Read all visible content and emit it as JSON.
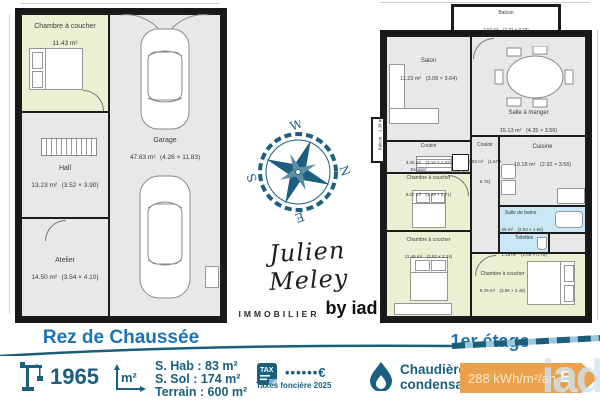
{
  "colors": {
    "teal": "#1A5F7D",
    "title_blue": "#1B74B5",
    "wall": "#181818",
    "room_gray": "#E8E8E8",
    "room_yellow": "#EDEFD2",
    "room_blue": "#C9E7F5",
    "energy_orange": "#EBA14C"
  },
  "ground_floor": {
    "title": "Rez de Chaussée",
    "rooms": [
      {
        "name": "Chambre à coucher",
        "area": "11.43 m²",
        "dims": ""
      },
      {
        "name": "Hall",
        "area": "13.23 m²",
        "dims": "(3.52 × 3.90)"
      },
      {
        "name": "Garage",
        "area": "47.63 m²",
        "dims": "(4.26 × 11.83)"
      },
      {
        "name": "Atelier",
        "area": "14.50 m²",
        "dims": "(3.54 × 4.10)"
      }
    ]
  },
  "first_floor": {
    "title": "1er étage",
    "rooms": [
      {
        "name": "Balcon",
        "area": "2.57 m²",
        "dims": "(3.32 × 0.78)"
      },
      {
        "name": "Salon",
        "area": "11.23 m²",
        "dims": "(3.09 × 3.64)"
      },
      {
        "name": "Salle à manger",
        "area": "15.13 m²",
        "dims": "(4.25 × 3.56)"
      },
      {
        "name": "Couloir",
        "area": "3.45 m²",
        "dims": "(3.10 × 1.32)"
      },
      {
        "name": "Couloir",
        "area": "5.93 m²",
        "dims": "(1.67 × 5.75)"
      },
      {
        "name": "Cuisine",
        "area": "10.18 m²",
        "dims": "(2.92 × 3.56)"
      },
      {
        "name": "Escalier",
        "area": "1.36 m²",
        "dims": ""
      },
      {
        "name": "Placard",
        "area": "",
        "dims": ""
      },
      {
        "name": "Balcon",
        "area": "1.38 m²",
        "dims": ""
      },
      {
        "name": "Chambre à coucher",
        "area": "9.27 m²",
        "dims": "(3.49 × 2.71)"
      },
      {
        "name": "Chambre à coucher",
        "area": "11.46 m²",
        "dims": "(3.53 × 3.34)"
      },
      {
        "name": "Salle de bains",
        "area": "4.08 m²",
        "dims": "(2.93 × 1.65)"
      },
      {
        "name": "Toilettes",
        "area": "1.18 m²",
        "dims": "(1.45 × 0.79)"
      },
      {
        "name": "Chambre à coucher",
        "area": "9.76 m²",
        "dims": "(3.96 × 2.49)"
      }
    ]
  },
  "compass": {
    "north": "N",
    "south": "S",
    "east": "E",
    "west": "W"
  },
  "signature": {
    "name": "Julien Meley",
    "subtitle": "IMMOBILIER",
    "byline": "by iad"
  },
  "footer": {
    "year": "1965",
    "surface_icon": "m²",
    "surfaces": [
      "S. Hab : 83 m²",
      "S. Sol : 174 m²",
      "Terrain : 600 m²"
    ],
    "tax_icon": "TAX",
    "tax_value": "••••••€",
    "tax_label": "Taxes foncière 2025",
    "heating_line1": "Chaudière gaz",
    "heating_line2": "condensation",
    "energy_value": "288 kWh/m²/an",
    "energy_class": "E",
    "watermark": "iad"
  }
}
